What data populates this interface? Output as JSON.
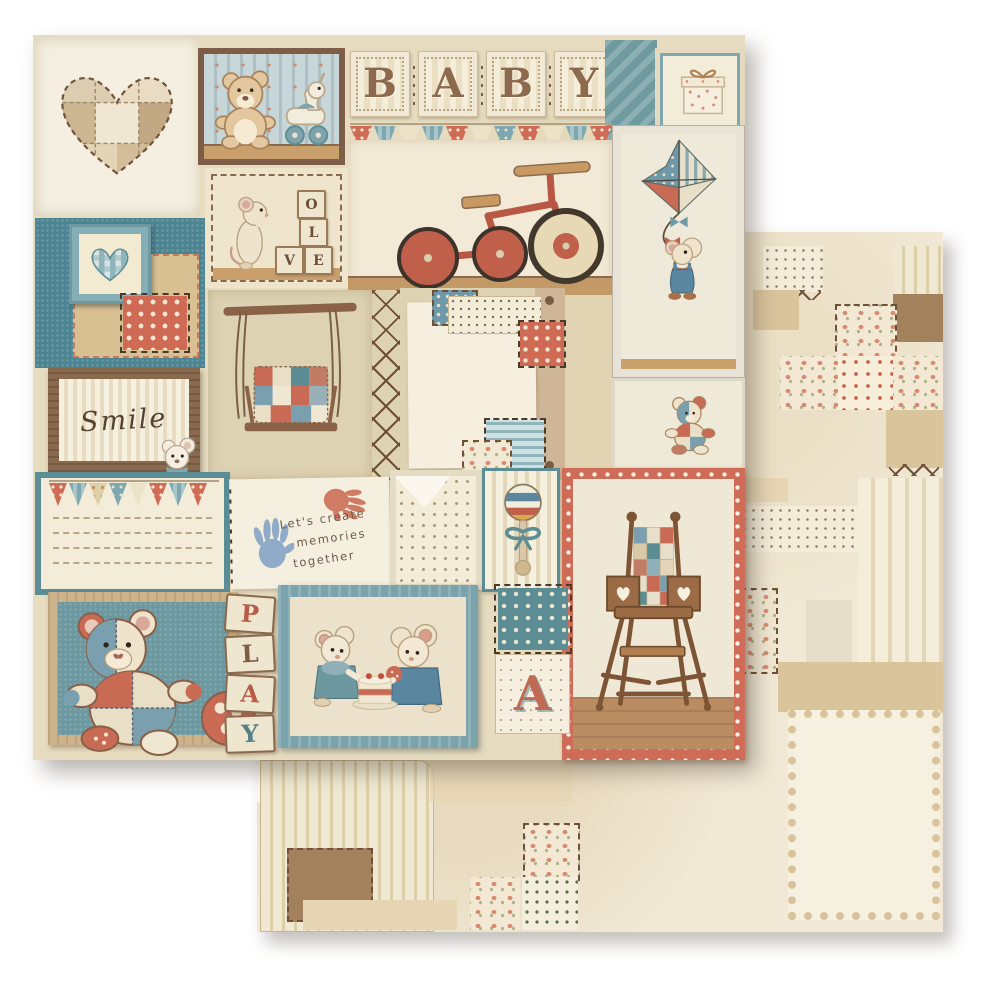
{
  "product": {
    "kind": "double-sided baby patchwork scrapbooking paper, two overlapping sheets",
    "front_sheet": "baby-themed patchwork collage of framed panels",
    "back_sheet": "muted cream patchwork with striped, floral, dotted and kraft patches"
  },
  "front": {
    "baby_letters": [
      "B",
      "A",
      "B",
      "Y"
    ],
    "love_block_letters": [
      "O",
      "L",
      "V",
      "E"
    ],
    "play_letters": [
      "P",
      "L",
      "A",
      "Y"
    ],
    "letter_card_text": "A",
    "smile_text": "Smile",
    "memories_lines": [
      "Let's create",
      "memories",
      "together"
    ]
  },
  "motifs": [
    "patchwork-heart",
    "teddy-bear-and-pull-horse",
    "baby-letter-blocks",
    "gift-box",
    "bunting-banner",
    "mouse-stacking-love-blocks",
    "red-tricycle",
    "mouse-flying-patchwork-kite",
    "gingham-heart-in-frame",
    "polka-dot-patch",
    "smile-frame-with-mouse",
    "porch-swing-with-quilt",
    "cross-stitch-seam",
    "patched-note-paper",
    "journaling-card-with-bunting",
    "handprints-card",
    "envelope-pocket",
    "baby-rattle",
    "wooden-high-chair",
    "patchwork-teddy-with-ball",
    "play-letter-blocks",
    "two-mice-sharing-cake",
    "letter-a-card",
    "small-patchwork-teddy"
  ],
  "palette": {
    "white_bg": "#ffffff",
    "cream": "#f1e9d6",
    "kraft": "#d9c49c",
    "wood_brown": "#8a6a4e",
    "dark_brown": "#6e5138",
    "teal": "#5d8d94",
    "denim_teal": "#4d8492",
    "slate_blue": "#7a9fae",
    "coral": "#cf6c55",
    "rust_red": "#b85c4a",
    "letter_brown": "#8d6a4e",
    "handprint_blue": "#7d9fc4",
    "handprint_coral": "#cc6e57"
  }
}
